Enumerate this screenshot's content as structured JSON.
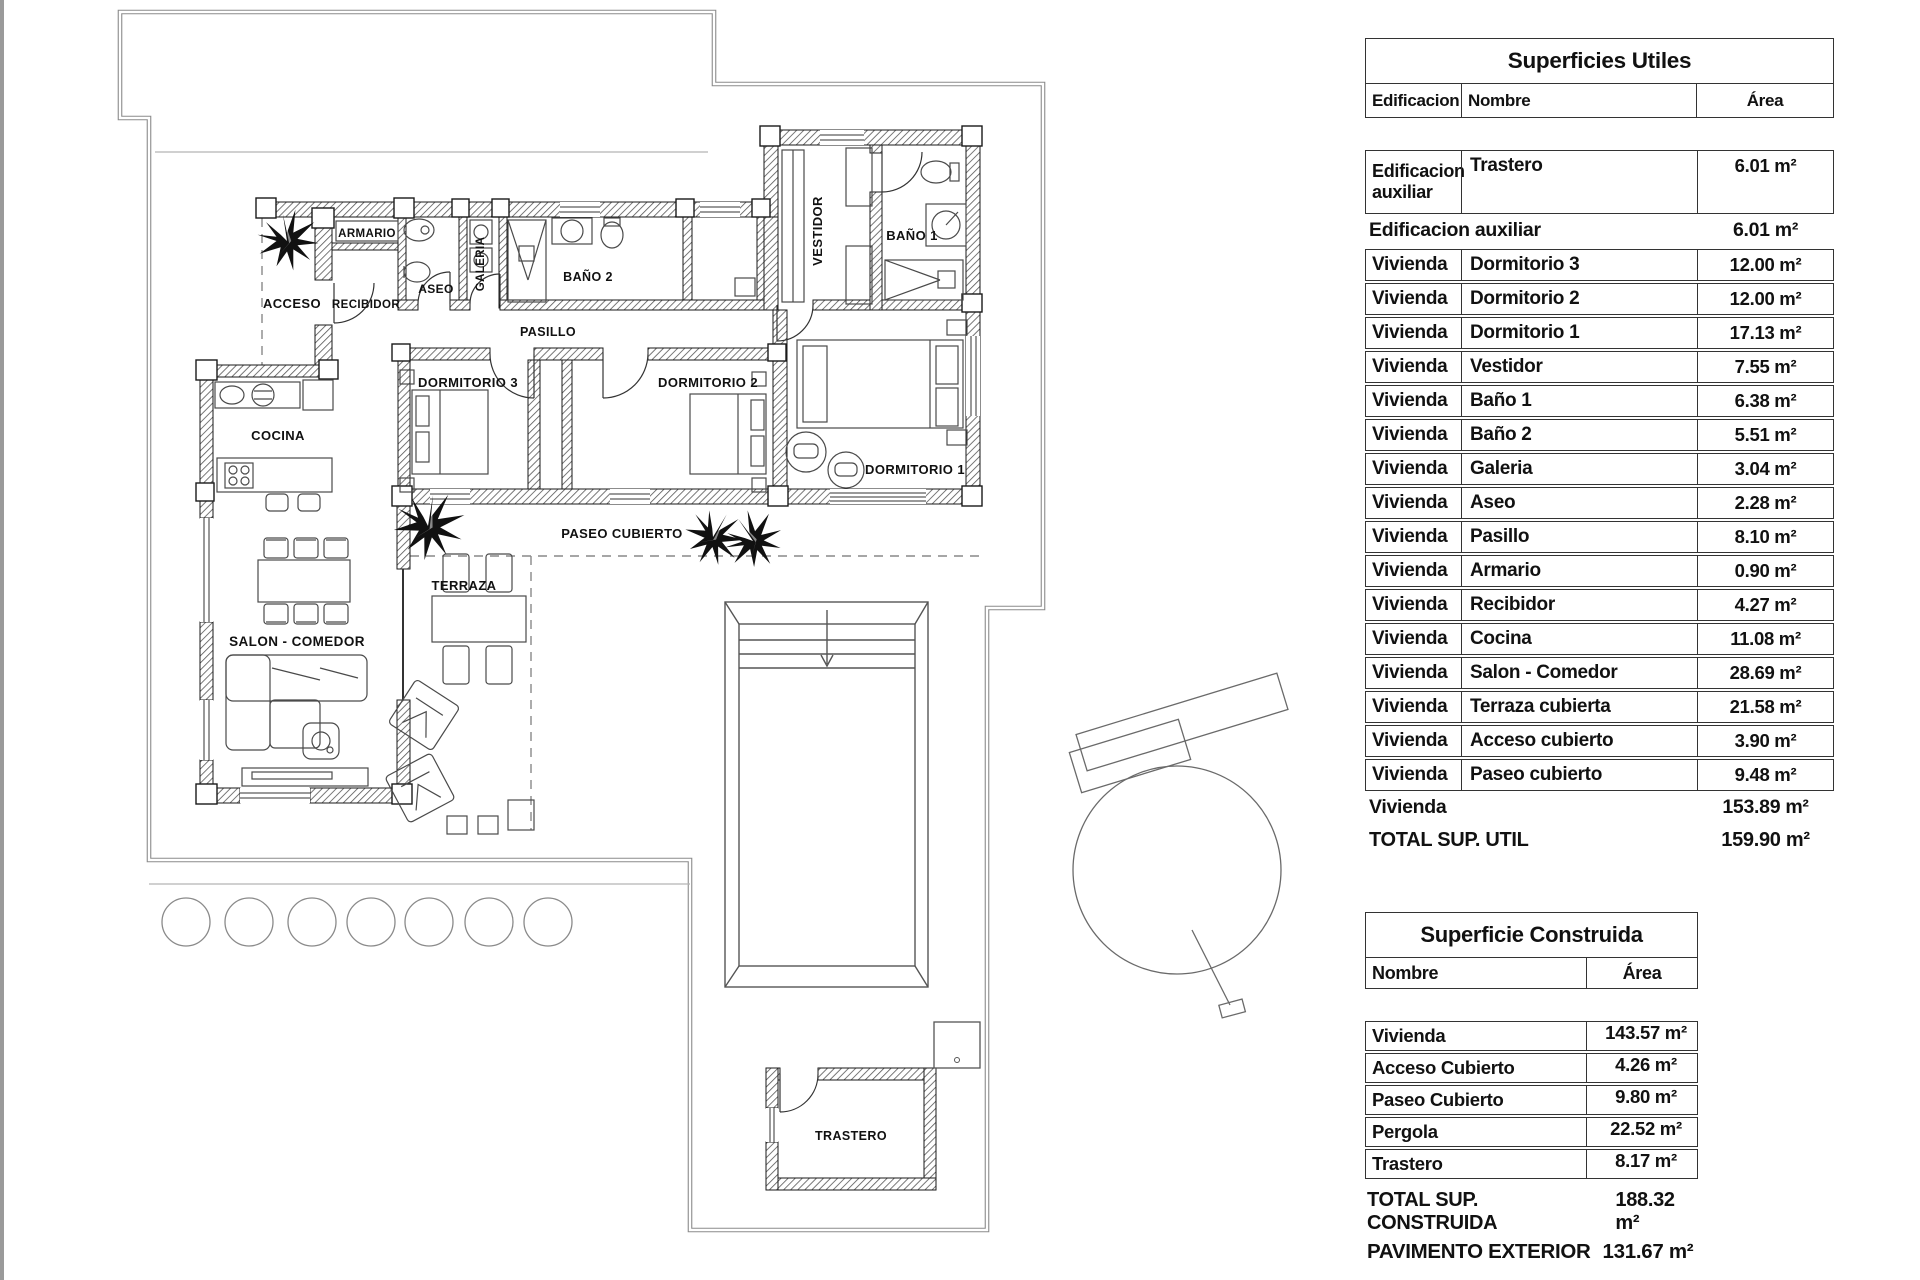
{
  "plan": {
    "labels": {
      "acceso": "ACCESO",
      "armario": "ARMARIO",
      "recibidor": "RECIBIDOR",
      "aseo": "ASEO",
      "galeria": "GALERIA",
      "bano2": "BAÑO 2",
      "pasillo": "PASILLO",
      "vestidor": "VESTIDOR",
      "bano1": "BAÑO 1",
      "dormitorio3": "DORMITORIO 3",
      "dormitorio2": "DORMITORIO 2",
      "dormitorio1": "DORMITORIO 1",
      "cocina": "COCINA",
      "salon_comedor": "SALON - COMEDOR",
      "terraza": "TERRAZA",
      "paseo_cubierto": "PASEO CUBIERTO",
      "trastero": "TRASTERO"
    }
  },
  "tables": {
    "utiles": {
      "title": "Superficies Utiles",
      "headers": {
        "edificacion": "Edificacion",
        "nombre": "Nombre",
        "area": "Área"
      },
      "aux_row": {
        "edificacion": "Edificacion auxiliar",
        "nombre": "Trastero",
        "area": "6.01 m²"
      },
      "aux_subtotal": {
        "label": "Edificacion auxiliar",
        "value": "6.01 m²"
      },
      "rows": [
        {
          "edificacion": "Vivienda",
          "nombre": "Dormitorio 3",
          "area": "12.00 m²"
        },
        {
          "edificacion": "Vivienda",
          "nombre": "Dormitorio 2",
          "area": "12.00 m²"
        },
        {
          "edificacion": "Vivienda",
          "nombre": "Dormitorio 1",
          "area": "17.13 m²"
        },
        {
          "edificacion": "Vivienda",
          "nombre": "Vestidor",
          "area": "7.55 m²"
        },
        {
          "edificacion": "Vivienda",
          "nombre": "Baño 1",
          "area": "6.38 m²"
        },
        {
          "edificacion": "Vivienda",
          "nombre": "Baño 2",
          "area": "5.51 m²"
        },
        {
          "edificacion": "Vivienda",
          "nombre": "Galeria",
          "area": "3.04 m²"
        },
        {
          "edificacion": "Vivienda",
          "nombre": "Aseo",
          "area": "2.28 m²"
        },
        {
          "edificacion": "Vivienda",
          "nombre": "Pasillo",
          "area": "8.10 m²"
        },
        {
          "edificacion": "Vivienda",
          "nombre": "Armario",
          "area": "0.90 m²"
        },
        {
          "edificacion": "Vivienda",
          "nombre": "Recibidor",
          "area": "4.27 m²"
        },
        {
          "edificacion": "Vivienda",
          "nombre": "Cocina",
          "area": "11.08 m²"
        },
        {
          "edificacion": "Vivienda",
          "nombre": "Salon - Comedor",
          "area": "28.69 m²"
        },
        {
          "edificacion": "Vivienda",
          "nombre": "Terraza cubierta",
          "area": "21.58 m²"
        },
        {
          "edificacion": "Vivienda",
          "nombre": "Acceso cubierto",
          "area": "3.90 m²"
        },
        {
          "edificacion": "Vivienda",
          "nombre": "Paseo cubierto",
          "area": "9.48 m²"
        }
      ],
      "vivienda_subtotal": {
        "label": "Vivienda",
        "value": "153.89 m²"
      },
      "total": {
        "label": "TOTAL SUP. UTIL",
        "value": "159.90 m²"
      }
    },
    "construida": {
      "title": "Superficie Construida",
      "headers": {
        "nombre": "Nombre",
        "area": "Área"
      },
      "rows": [
        {
          "nombre": "Vivienda",
          "area": "143.57 m²"
        },
        {
          "nombre": "Acceso Cubierto",
          "area": "4.26 m²"
        },
        {
          "nombre": "Paseo Cubierto",
          "area": "9.80 m²"
        },
        {
          "nombre": "Pergola",
          "area": "22.52 m²"
        },
        {
          "nombre": "Trastero",
          "area": "8.17 m²"
        }
      ],
      "total": {
        "label": "TOTAL SUP. CONSTRUIDA",
        "value": "188.32 m²"
      },
      "pavimento": {
        "label": "PAVIMENTO EXTERIOR",
        "value": "131.67 m²"
      }
    }
  }
}
